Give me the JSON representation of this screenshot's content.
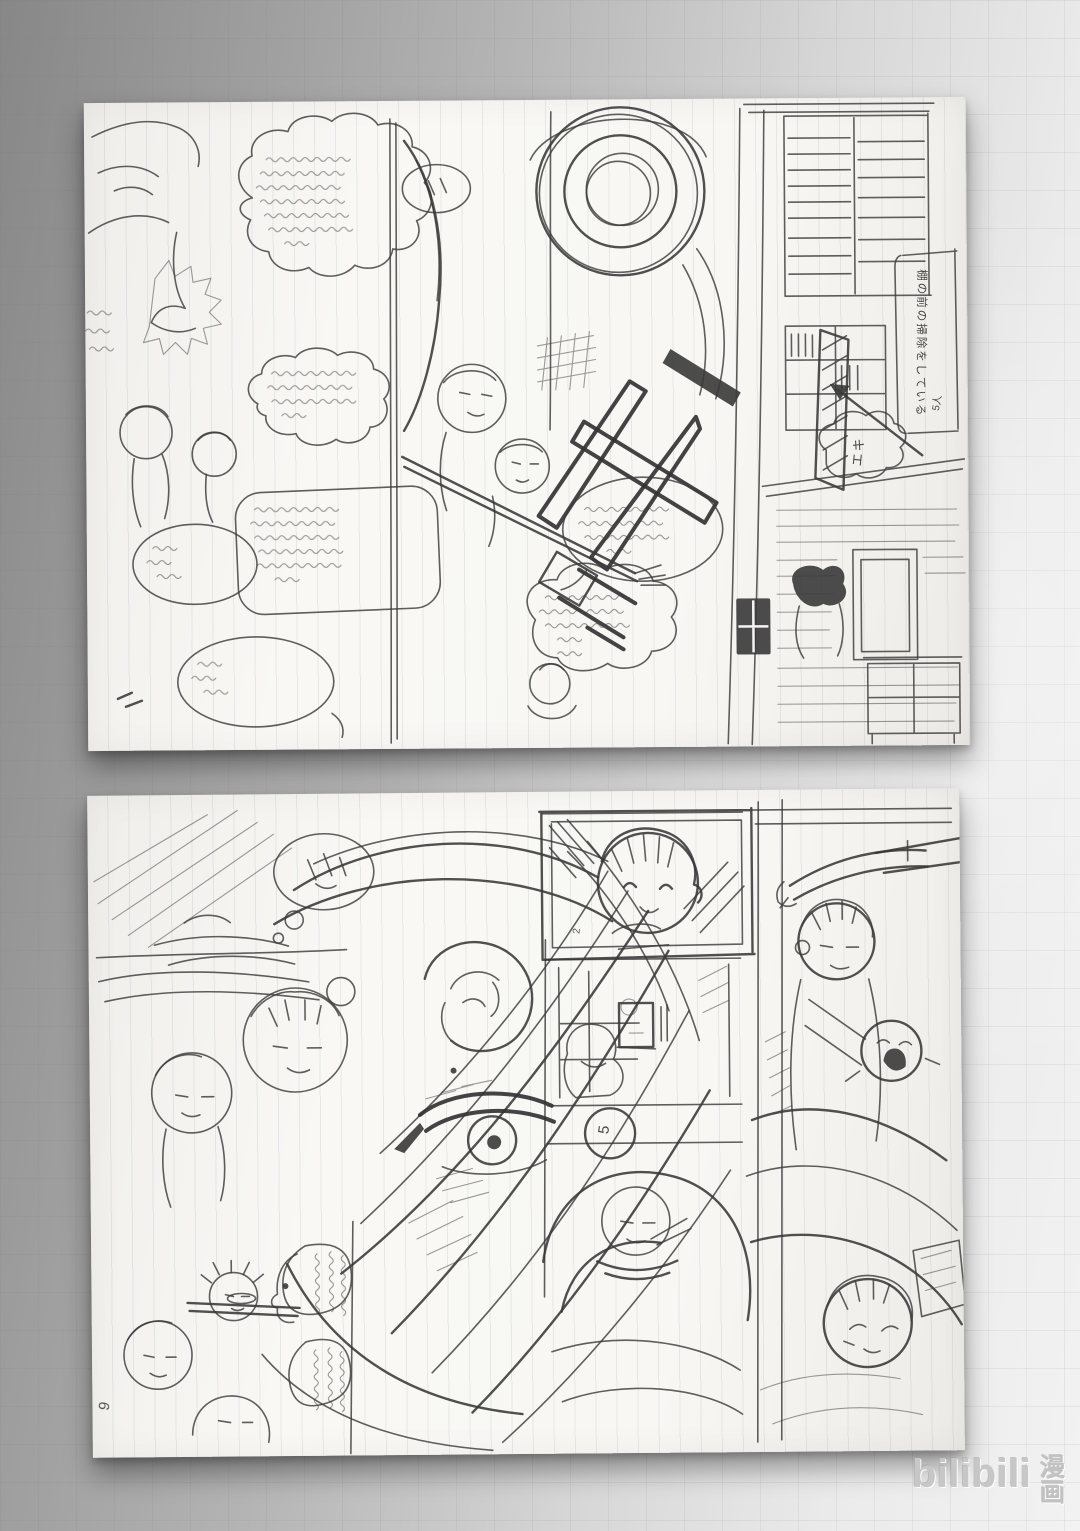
{
  "watermark": {
    "logo": "bilibili",
    "suffix": "漫画"
  },
  "scene": {
    "description": "Two hand-drawn manga storyboard (name) pages on ruled loose-leaf paper, lying sideways on a gray graph-paper surface",
    "background_left": "#878787",
    "background_right": "#f2f2f2",
    "paper_color": "#f8f7f4",
    "pencil_color": "#3c3c3c"
  },
  "page_top": {
    "margin_note": {
      "text": "棚の前の掃除をしている",
      "subtext": "5人"
    },
    "bubble_sfx": "エキ",
    "handwriting": "illegible pencil dialogue in speech bubbles"
  },
  "page_bottom": {
    "page_number": "9",
    "circled_panel_number": "5",
    "frame_panel_number": "2",
    "handwriting": "illegible pencil dialogue in speech bubbles"
  }
}
